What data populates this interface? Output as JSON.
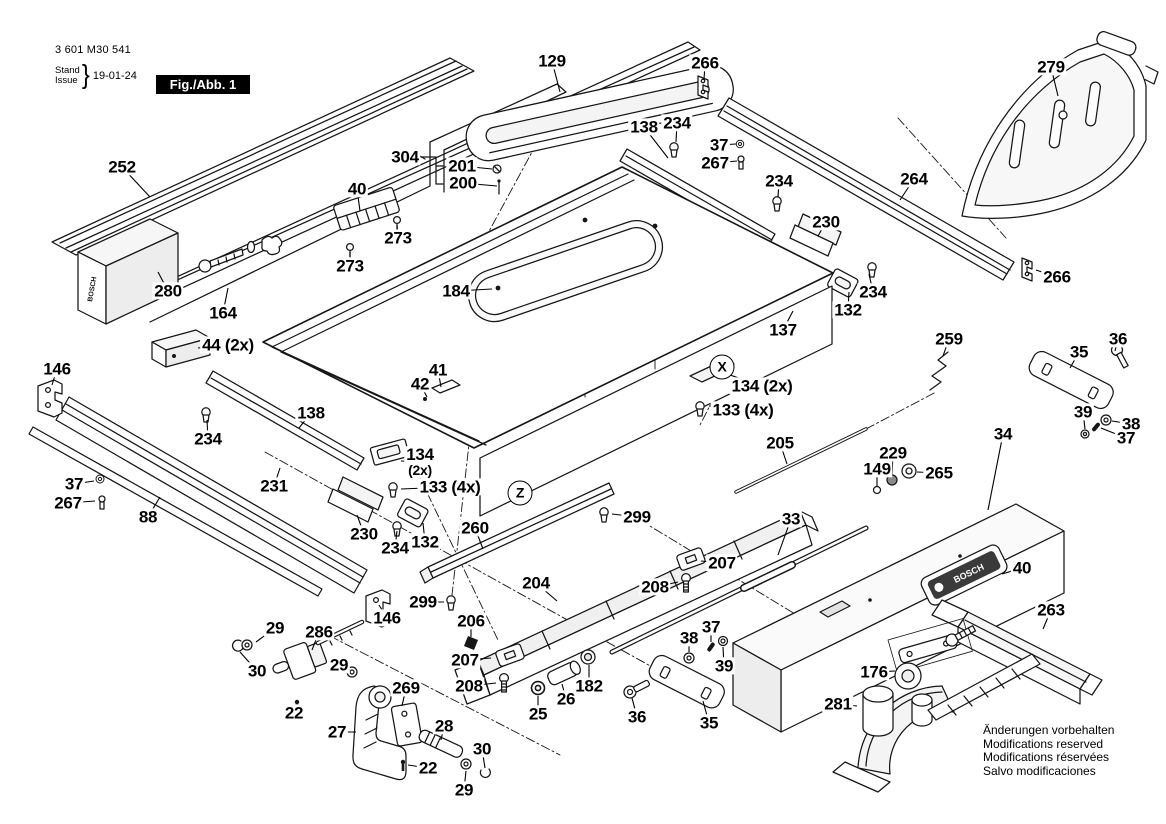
{
  "doc": {
    "part_number": "3 601 M30 541",
    "stand_label": "Stand",
    "issue_label": "Issue",
    "brace": "}",
    "date": "19-01-24",
    "figure_label": "Fig./Abb. 1"
  },
  "brand": "BOSCH",
  "notice_lines": [
    "Änderungen vorbehalten",
    "Modifications reserved",
    "Modifications réservées",
    "Salvo modificaciones"
  ],
  "view_markers": [
    {
      "label": "X",
      "x": 722,
      "y": 367
    },
    {
      "label": "Z",
      "x": 520,
      "y": 493
    }
  ],
  "callouts": [
    {
      "label": "252",
      "x": 122,
      "y": 167,
      "lx": 150,
      "ly": 197
    },
    {
      "label": "304",
      "x": 405,
      "y": 157
    },
    {
      "label": "201",
      "x": 462,
      "y": 166,
      "lx": 492,
      "ly": 169
    },
    {
      "label": "200",
      "x": 463,
      "y": 183,
      "lx": 497,
      "ly": 186
    },
    {
      "label": "129",
      "x": 552,
      "y": 61,
      "lx": 560,
      "ly": 92
    },
    {
      "label": "266",
      "x": 705,
      "y": 63,
      "lx": 704,
      "ly": 80
    },
    {
      "label": "138",
      "x": 644,
      "y": 127,
      "lx": 668,
      "ly": 158
    },
    {
      "label": "234",
      "x": 677,
      "y": 123,
      "lx": 676,
      "ly": 142
    },
    {
      "label": "37",
      "x": 719,
      "y": 145,
      "lx": 736,
      "ly": 144
    },
    {
      "label": "267",
      "x": 715,
      "y": 163,
      "lx": 737,
      "ly": 161
    },
    {
      "label": "234",
      "x": 779,
      "y": 181,
      "lx": 778,
      "ly": 197
    },
    {
      "label": "264",
      "x": 914,
      "y": 179,
      "lx": 900,
      "ly": 200
    },
    {
      "label": "279",
      "x": 1051,
      "y": 67,
      "lx": 1058,
      "ly": 96
    },
    {
      "label": "266",
      "x": 1057,
      "y": 277,
      "lx": 1036,
      "ly": 270
    },
    {
      "label": "230",
      "x": 826,
      "y": 222,
      "lx": 818,
      "ly": 236
    },
    {
      "label": "234",
      "x": 873,
      "y": 292,
      "lx": 869,
      "ly": 274
    },
    {
      "label": "132",
      "x": 848,
      "y": 310,
      "lx": 849,
      "ly": 292
    },
    {
      "label": "137",
      "x": 783,
      "y": 330,
      "lx": 793,
      "ly": 311
    },
    {
      "label": "134 (2x)",
      "x": 762,
      "y": 386,
      "lx": 730,
      "ly": 375
    },
    {
      "label": "133 (4x)",
      "x": 743,
      "y": 410,
      "lx": 709,
      "ly": 406
    },
    {
      "label": "259",
      "x": 949,
      "y": 339,
      "lx": 943,
      "ly": 356
    },
    {
      "label": "40",
      "x": 357,
      "y": 189,
      "lx": 360,
      "ly": 211
    },
    {
      "label": "273",
      "x": 398,
      "y": 238,
      "lx": 397,
      "ly": 225
    },
    {
      "label": "273",
      "x": 350,
      "y": 266,
      "lx": 350,
      "ly": 252
    },
    {
      "label": "280",
      "x": 168,
      "y": 291,
      "lx": 158,
      "ly": 272
    },
    {
      "label": "164",
      "x": 223,
      "y": 313,
      "lx": 228,
      "ly": 288
    },
    {
      "label": "44 (2x)",
      "x": 228,
      "y": 345,
      "lx": 198,
      "ly": 348
    },
    {
      "label": "146",
      "x": 57,
      "y": 369,
      "lx": 52,
      "ly": 385
    },
    {
      "label": "184",
      "x": 456,
      "y": 291,
      "lx": 492,
      "ly": 289
    },
    {
      "label": "41",
      "x": 438,
      "y": 370,
      "lx": 441,
      "ly": 387
    },
    {
      "label": "42",
      "x": 420,
      "y": 384,
      "lx": 427,
      "ly": 397
    },
    {
      "label": "138",
      "x": 311,
      "y": 413,
      "lx": 299,
      "ly": 428
    },
    {
      "label": "234",
      "x": 208,
      "y": 439,
      "lx": 207,
      "ly": 420
    },
    {
      "label": "37",
      "x": 74,
      "y": 484,
      "lx": 94,
      "ly": 481
    },
    {
      "label": "267",
      "x": 68,
      "y": 503,
      "lx": 95,
      "ly": 501
    },
    {
      "label": "88",
      "x": 148,
      "y": 517,
      "lx": 160,
      "ly": 497
    },
    {
      "label": "231",
      "x": 274,
      "y": 486,
      "lx": 280,
      "ly": 468
    },
    {
      "label": "230",
      "x": 364,
      "y": 534,
      "lx": 357,
      "ly": 515
    },
    {
      "label": "134",
      "sub": "(2x)",
      "x": 420,
      "y": 462,
      "lx": 401,
      "ly": 461
    },
    {
      "label": "133 (4x)",
      "x": 450,
      "y": 487,
      "lx": 401,
      "ly": 489
    },
    {
      "label": "234",
      "x": 395,
      "y": 548,
      "lx": 397,
      "ly": 531
    },
    {
      "label": "132",
      "x": 425,
      "y": 542,
      "lx": 423,
      "ly": 523
    },
    {
      "label": "260",
      "x": 475,
      "y": 528,
      "lx": 483,
      "ly": 549
    },
    {
      "label": "299",
      "x": 637,
      "y": 517,
      "lx": 612,
      "ly": 514
    },
    {
      "label": "299",
      "x": 423,
      "y": 602,
      "lx": 444,
      "ly": 602
    },
    {
      "label": "146",
      "x": 387,
      "y": 618,
      "lx": 379,
      "ly": 605
    },
    {
      "label": "204",
      "x": 536,
      "y": 583,
      "lx": 557,
      "ly": 601
    },
    {
      "label": "206",
      "x": 471,
      "y": 621,
      "lx": 471,
      "ly": 637
    },
    {
      "label": "207",
      "x": 465,
      "y": 660,
      "lx": 491,
      "ly": 658
    },
    {
      "label": "208",
      "x": 469,
      "y": 686,
      "lx": 496,
      "ly": 683
    },
    {
      "label": "207",
      "x": 722,
      "y": 563,
      "lx": 701,
      "ly": 561
    },
    {
      "label": "208",
      "x": 655,
      "y": 587,
      "lx": 678,
      "ly": 582
    },
    {
      "label": "205",
      "x": 780,
      "y": 443,
      "lx": 787,
      "ly": 464
    },
    {
      "label": "33",
      "x": 791,
      "y": 519,
      "lx": 778,
      "ly": 555
    },
    {
      "label": "34",
      "x": 1003,
      "y": 434,
      "lx": 988,
      "ly": 510
    },
    {
      "label": "229",
      "x": 893,
      "y": 453,
      "lx": 892,
      "ly": 475
    },
    {
      "label": "149",
      "x": 877,
      "y": 469,
      "lx": 877,
      "ly": 486
    },
    {
      "label": "265",
      "x": 939,
      "y": 473,
      "lx": 917,
      "ly": 472
    },
    {
      "label": "36",
      "x": 1118,
      "y": 339,
      "lx": 1115,
      "ly": 351
    },
    {
      "label": "35",
      "x": 1079,
      "y": 352,
      "lx": 1070,
      "ly": 368
    },
    {
      "label": "39",
      "x": 1083,
      "y": 412,
      "lx": 1085,
      "ly": 429
    },
    {
      "label": "38",
      "x": 1131,
      "y": 424,
      "lx": 1112,
      "ly": 421
    },
    {
      "label": "37",
      "x": 1126,
      "y": 438,
      "lx": 1101,
      "ly": 428
    },
    {
      "label": "29",
      "x": 275,
      "y": 628,
      "lx": 256,
      "ly": 642
    },
    {
      "label": "286",
      "x": 319,
      "y": 632,
      "lx": 312,
      "ly": 650
    },
    {
      "label": "30",
      "x": 257,
      "y": 671,
      "lx": 240,
      "ly": 652
    },
    {
      "label": "29",
      "x": 339,
      "y": 665,
      "lx": 350,
      "ly": 670
    },
    {
      "label": "22",
      "x": 294,
      "y": 713,
      "lx": 297,
      "ly": 706
    },
    {
      "label": "27",
      "x": 337,
      "y": 732,
      "lx": 356,
      "ly": 732
    },
    {
      "label": "269",
      "x": 406,
      "y": 688,
      "lx": 402,
      "ly": 706
    },
    {
      "label": "28",
      "x": 444,
      "y": 726,
      "lx": 441,
      "ly": 740
    },
    {
      "label": "22",
      "x": 428,
      "y": 768,
      "lx": 408,
      "ly": 765
    },
    {
      "label": "30",
      "x": 482,
      "y": 749,
      "lx": 485,
      "ly": 768
    },
    {
      "label": "29",
      "x": 464,
      "y": 790,
      "lx": 466,
      "ly": 771
    },
    {
      "label": "25",
      "x": 538,
      "y": 714,
      "lx": 538,
      "ly": 696
    },
    {
      "label": "26",
      "x": 566,
      "y": 699,
      "lx": 562,
      "ly": 684
    },
    {
      "label": "182",
      "x": 589,
      "y": 686,
      "lx": 589,
      "ly": 665
    },
    {
      "label": "38",
      "x": 689,
      "y": 638,
      "lx": 689,
      "ly": 652
    },
    {
      "label": "37",
      "x": 711,
      "y": 627,
      "lx": 711,
      "ly": 642
    },
    {
      "label": "39",
      "x": 724,
      "y": 666,
      "lx": 723,
      "ly": 647
    },
    {
      "label": "36",
      "x": 637,
      "y": 717,
      "lx": 632,
      "ly": 698
    },
    {
      "label": "35",
      "x": 709,
      "y": 723,
      "lx": 703,
      "ly": 701
    },
    {
      "label": "281",
      "x": 838,
      "y": 704,
      "lx": 857,
      "ly": 706
    },
    {
      "label": "176",
      "x": 874,
      "y": 672,
      "lx": 895,
      "ly": 671
    },
    {
      "label": "263",
      "x": 1051,
      "y": 610,
      "lx": 1043,
      "ly": 629
    },
    {
      "label": "40",
      "x": 1022,
      "y": 568,
      "lx": 1002,
      "ly": 574
    }
  ]
}
